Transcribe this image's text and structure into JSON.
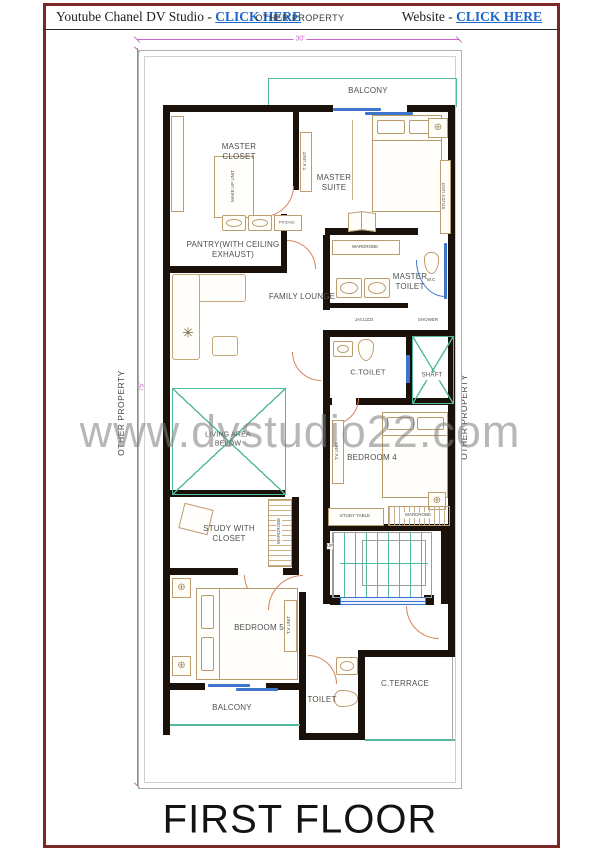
{
  "header": {
    "youtube_label": "Youtube Chanel DV Studio -",
    "youtube_link": "CLICK HERE",
    "center": "OTHER PROPERTY",
    "website_label": "Website -",
    "website_link": "CLICK HERE"
  },
  "dimensions": {
    "top": "30'",
    "left": "75'"
  },
  "boundaries": {
    "left": "OTHER PROPERTY",
    "right": "OTHER PROPERTY"
  },
  "rooms": {
    "balcony_top": "BALCONY",
    "master_closet": "MASTER CLOSET",
    "master_suite": "MASTER SUITE",
    "pantry": "PANTRY(WITH CEILING EXHAUST)",
    "family_lounge": "FAMILY LOUNGE",
    "master_toilet": "MASTER TOILET",
    "c_toilet": "C.TOILET",
    "shaft": "SHAFT",
    "living_area_below": "LIVING AREA BELOW",
    "bedroom4": "BEDROOM 4",
    "study_with_closet": "STUDY WITH CLOSET",
    "bedroom5": "BEDROOM 5",
    "balcony_bottom": "BALCONY",
    "toilet": "TOILET",
    "c_terrace": "C.TERRACE"
  },
  "fixtures": {
    "tv_unit_closet": "T V UNIT",
    "study_unit": "STUDY UNIT",
    "fridge": "FRIDGE",
    "makeup_unit": "MAKE UP UNIT",
    "wardrobe_master": "WARDROBE",
    "wc": "W.C",
    "jacuzzi": "JACUZZI",
    "shower": "SHOWER",
    "tv_unit_bed4": "T.V UNIT",
    "study_table": "STUDY TABLE",
    "wardrobe_bed4": "WARDROBE",
    "wardrobe_study": "WARDROBE",
    "tv_unit_bed5": "T.V UNIT",
    "up": "UP"
  },
  "icons": {
    "fan": "⊕",
    "plant": "✳"
  },
  "watermark": "www.dvstudio22.com",
  "title": "FIRST FLOOR",
  "colors": {
    "frame_maroon": "#7b2726",
    "link_blue": "#1b66c9",
    "wall_black": "#1a110a",
    "accent_teal": "#52b89e",
    "window_blue": "#3f74cc",
    "door_salmon": "#d4845c",
    "dimension_magenta": "#c966c9",
    "furniture_tan": "#bb9d6f"
  }
}
